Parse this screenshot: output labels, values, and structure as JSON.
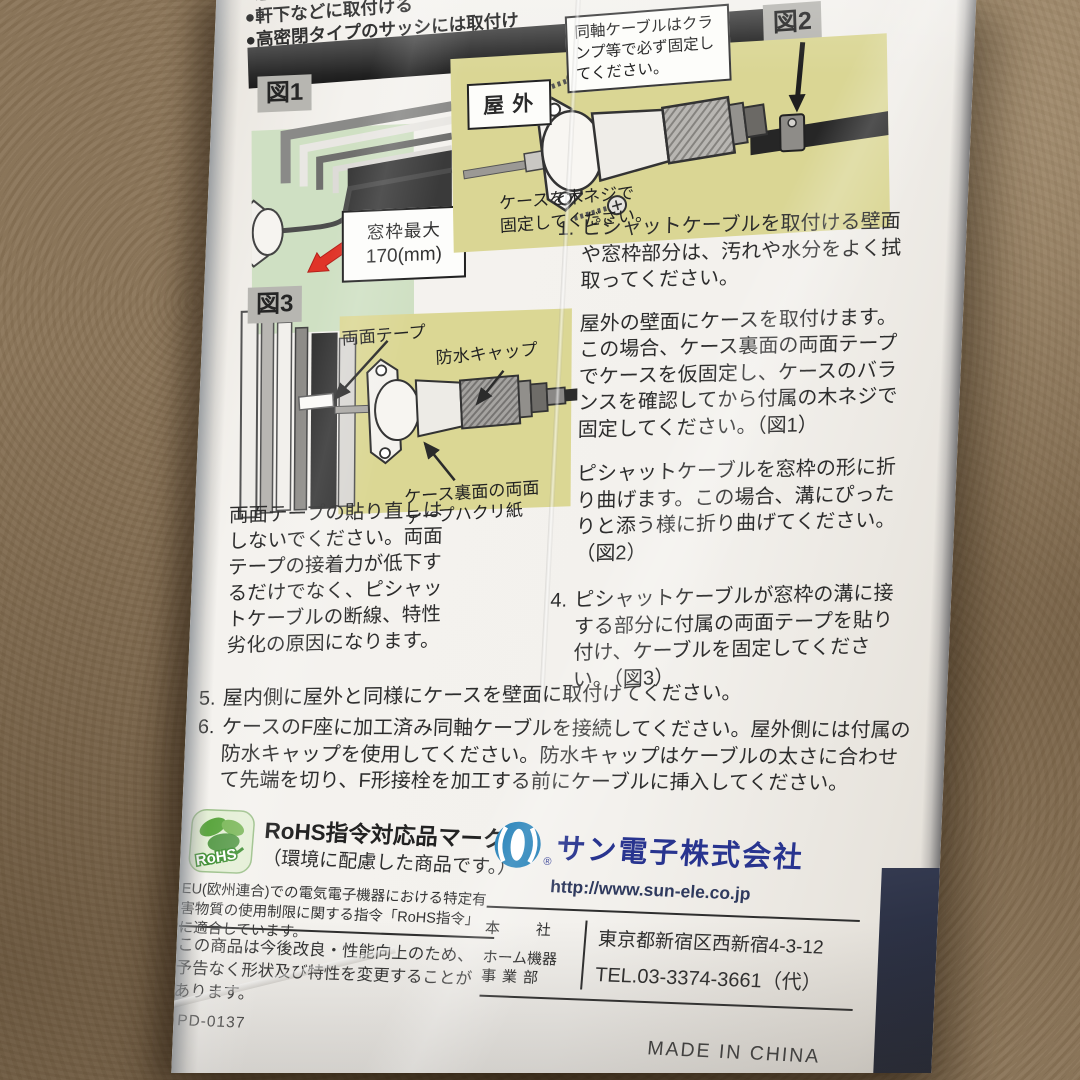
{
  "top_bullets": {
    "items": [
      "●",
      "●窓の開閉",
      "●軒下などに取付ける",
      "●高密閉タイプのサッシには取付け"
    ]
  },
  "header": {
    "title": "取付方法"
  },
  "fig1": {
    "label": "図1",
    "note_line1": "窓枠最大",
    "note_line2": "170(mm)"
  },
  "fig2": {
    "label": "図2",
    "ok_mark": "○",
    "ng_mark": "×"
  },
  "outdoor": {
    "label": "屋外",
    "clamp_note": "同軸ケーブルはクランプ等で必ず固定してください。",
    "screw_note": "ケースを木ネジで固定してください。"
  },
  "fig3": {
    "label": "図3",
    "tape_label": "両面テープ",
    "cap_label": "防水キャップ",
    "release_label": "ケース裏面の両面テープハクリ紙"
  },
  "warning": "両面テープの貼り直しはしないでください。両面テープの接着力が低下するだけでなく、ピシャットケーブルの断線、特性劣化の原因になります。",
  "steps": [
    {
      "num": "1.",
      "text": "ピシャットケーブルを取付ける壁面や窓枠部分は、汚れや水分をよく拭取ってください。"
    },
    {
      "num": "2.",
      "text": "屋外の壁面にケースを取付けます。この場合、ケース裏面の両面テープでケースを仮固定し、ケースのバランスを確認してから付属の木ネジで固定してください。（図1）"
    },
    {
      "num": "3.",
      "text": "ピシャットケーブルを窓枠の形に折り曲げます。この場合、溝にぴったりと添う様に折り曲げてください。（図2）"
    },
    {
      "num": "4.",
      "text": "ピシャットケーブルが窓枠の溝に接する部分に付属の両面テープを貼り付け、ケーブルを固定してください。（図3）"
    },
    {
      "num": "5.",
      "text": "屋内側に屋外と同様にケースを壁面に取付けてください。"
    },
    {
      "num": "6.",
      "text": "ケースのF座に加工済み同軸ケーブルを接続してください。屋外側には付属の防水キャップを使用してください。防水キャップはケーブルの太さに合わせて先端を切り、F形接栓を加工する前にケーブルに挿入してください。"
    }
  ],
  "rohs": {
    "logo_text": "RoHS",
    "title": "RoHS指令対応品マーク",
    "subtitle": "（環境に配慮した商品です。）",
    "body": "EU(欧州連合)での電気電子機器における特定有害物質の使用制限に関する指令「RoHS指令」に適合しています。"
  },
  "notice": "この商品は今後改良・性能向上のため、予告なく形状及び特性を変更することがあります。",
  "model_code": "PD-0137",
  "company": {
    "name": "サン電子株式会社",
    "reg_mark": "®",
    "url": "http://www.sun-ele.co.jp",
    "office1": "本　　社",
    "office2_line1": "ホーム機器",
    "office2_line2": "事業部",
    "address": "東京都新宿区西新宿4-3-12",
    "tel": "TEL.03-3374-3661（代）"
  },
  "made_in": "MADE IN CHINA",
  "colors": {
    "header_bar": "#262626",
    "panel_yellow": "#dad694",
    "panel_green": "#cfe0c3",
    "ok_red": "#d7281f",
    "ng_blue": "#2c3c9c",
    "logo_blue": "#1b7cb6",
    "company_blue": "#28348f",
    "rohs_green": "#3f9b3c"
  }
}
